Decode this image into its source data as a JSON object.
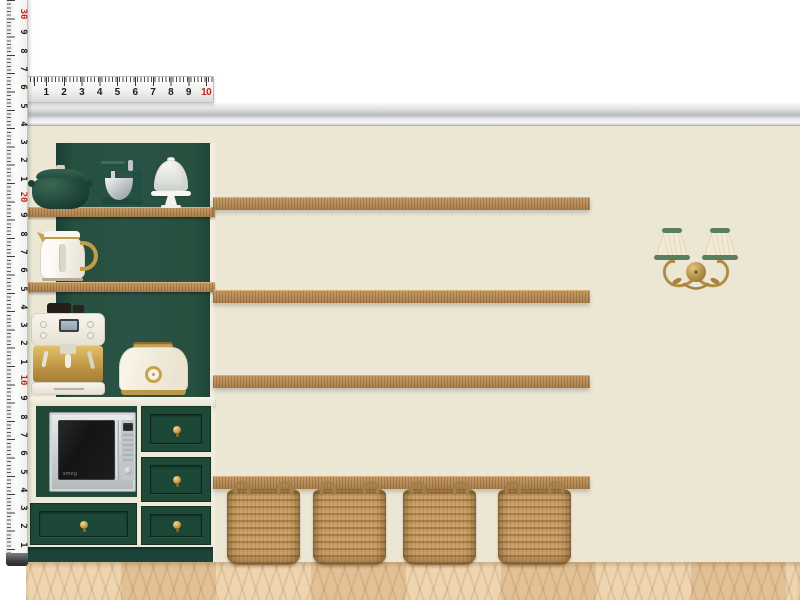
{
  "scene": {
    "type": "interior-design moodboard — pantry wall elevation",
    "microwave_brand": "smeg",
    "shelf_count": 4,
    "basket_count": 4,
    "items": [
      "measuring-tape",
      "steel-ruler",
      "crown-molding",
      "green-hutch",
      "dutch-oven",
      "stand-mixer",
      "cake-stand",
      "kettle",
      "espresso-machine",
      "toaster",
      "built-in-microwave",
      "drawer-unit",
      "counter-top",
      "toe-kick",
      "wall-shelves",
      "storage-baskets",
      "double-wall-sconce",
      "chevron-wood-floor"
    ]
  },
  "rulers": {
    "horizontal": {
      "numbers": [
        {
          "label": "1"
        },
        {
          "label": "2"
        },
        {
          "label": "3"
        },
        {
          "label": "4"
        },
        {
          "label": "5"
        },
        {
          "label": "6"
        },
        {
          "label": "7"
        },
        {
          "label": "8"
        },
        {
          "label": "9"
        },
        {
          "label": "10",
          "red": true
        }
      ]
    },
    "vertical": {
      "numbers": [
        {
          "label": "30",
          "red": true
        },
        {
          "label": "9"
        },
        {
          "label": "8"
        },
        {
          "label": "7"
        },
        {
          "label": "6"
        },
        {
          "label": "5"
        },
        {
          "label": "4"
        },
        {
          "label": "3"
        },
        {
          "label": "2"
        },
        {
          "label": "1"
        },
        {
          "label": "20",
          "red": true
        },
        {
          "label": "9"
        },
        {
          "label": "8"
        },
        {
          "label": "7"
        },
        {
          "label": "6"
        },
        {
          "label": "5"
        },
        {
          "label": "4"
        },
        {
          "label": "3"
        },
        {
          "label": "2"
        },
        {
          "label": "1"
        },
        {
          "label": "10",
          "red": true
        },
        {
          "label": "9"
        },
        {
          "label": "8"
        },
        {
          "label": "7"
        },
        {
          "label": "6"
        },
        {
          "label": "5"
        },
        {
          "label": "4"
        },
        {
          "label": "3"
        },
        {
          "label": "2"
        },
        {
          "label": "1"
        }
      ]
    }
  },
  "palette": {
    "wall": "#ECE7D5",
    "cabinet_green": "#2A5246",
    "drawer_green": "#1E4939",
    "shelf_wood": "#B68B5B",
    "floor_wood": "#E9CCA5",
    "brass": "#C29A4A",
    "molding_gray": "#C6C9CC",
    "basket_tan": "#C39A63",
    "ruler_red": "#C0271E",
    "sconce_trim_green": "#5A7F5F",
    "appliance_cream": "#F5F1E6"
  }
}
